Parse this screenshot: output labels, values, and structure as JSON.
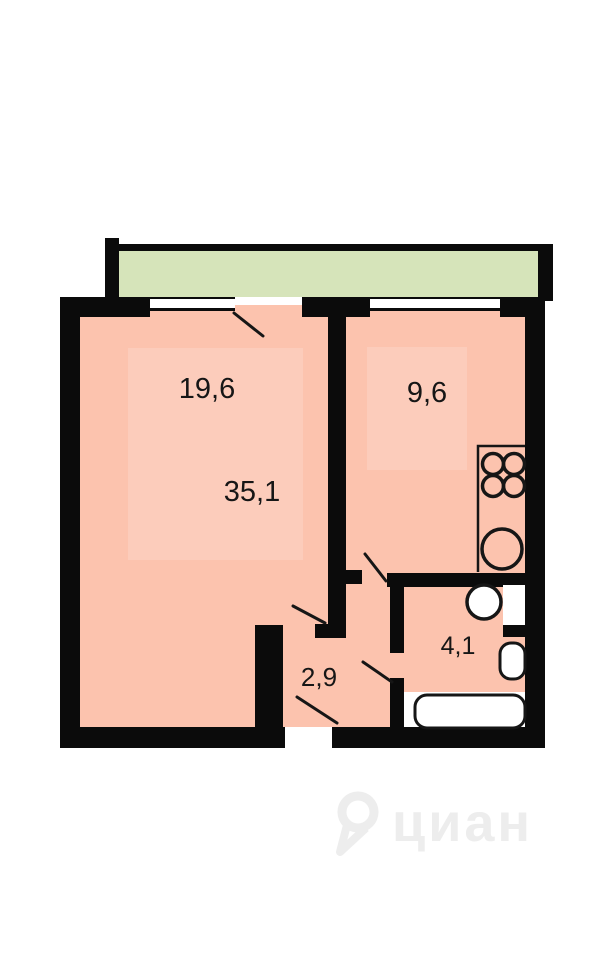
{
  "plan": {
    "type": "apartment-floor-plan",
    "labels": {
      "living_area": "19,6",
      "total_area": "35,1",
      "kitchen_area": "9,6",
      "hallway_area": "2,9",
      "bathroom_area": "4,1"
    },
    "fixtures": [
      "stove-burners-icon",
      "kitchen-sink-icon",
      "washbasin-icon",
      "toilet-icon",
      "bathtub-icon",
      "window-icon",
      "door-swing-icon"
    ],
    "colors": {
      "room_fill": "#fcc3ae",
      "balcony_fill": "#d6e4ba",
      "wall": "#0b0b0b",
      "watermark": "#ededed"
    },
    "watermark": {
      "text": "циан"
    }
  }
}
